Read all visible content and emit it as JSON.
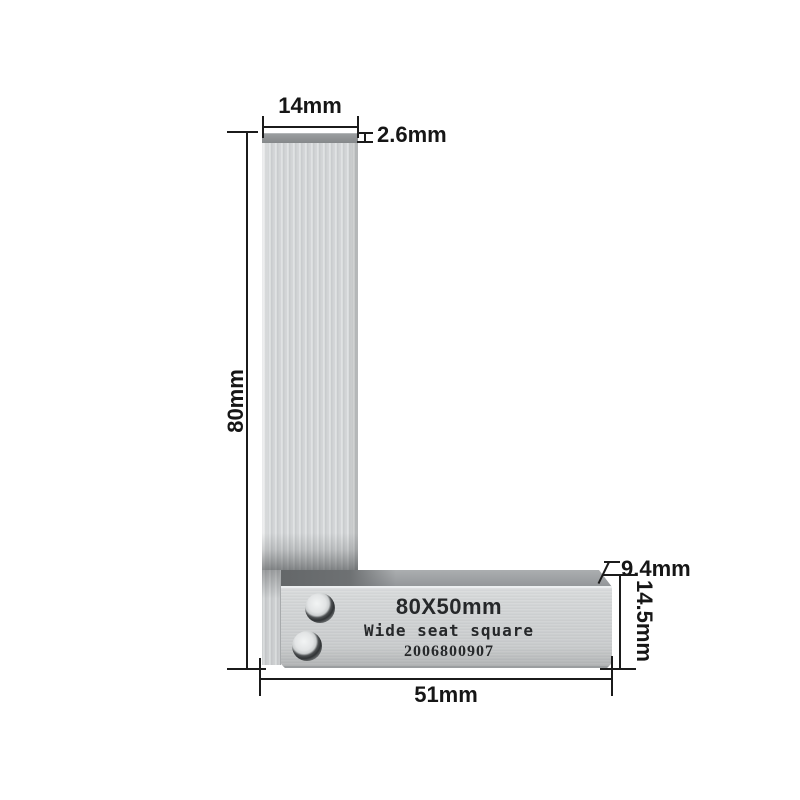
{
  "tool": {
    "size_label": "80X50mm",
    "name_label": "Wide seat square",
    "serial_number": "2006800907",
    "colors": {
      "blade_light": "#d6d9da",
      "blade_streak_dark": "#c3c6c8",
      "blade_top_cap": "#8a8d8f",
      "seat_body": "#ced1d2",
      "seat_top_strip": "#9da0a2",
      "seat_shadow_strip": "#6e7173",
      "rivet_ring": "#3f4244",
      "dimension_line": "#1b1b1b",
      "background": "#ffffff"
    }
  },
  "dimensions": {
    "blade_width": "14mm",
    "blade_thickness": "2.6mm",
    "blade_length": "80mm",
    "seat_top_offset": "9.4mm",
    "seat_thickness": "14.5mm",
    "seat_length": "51mm"
  }
}
